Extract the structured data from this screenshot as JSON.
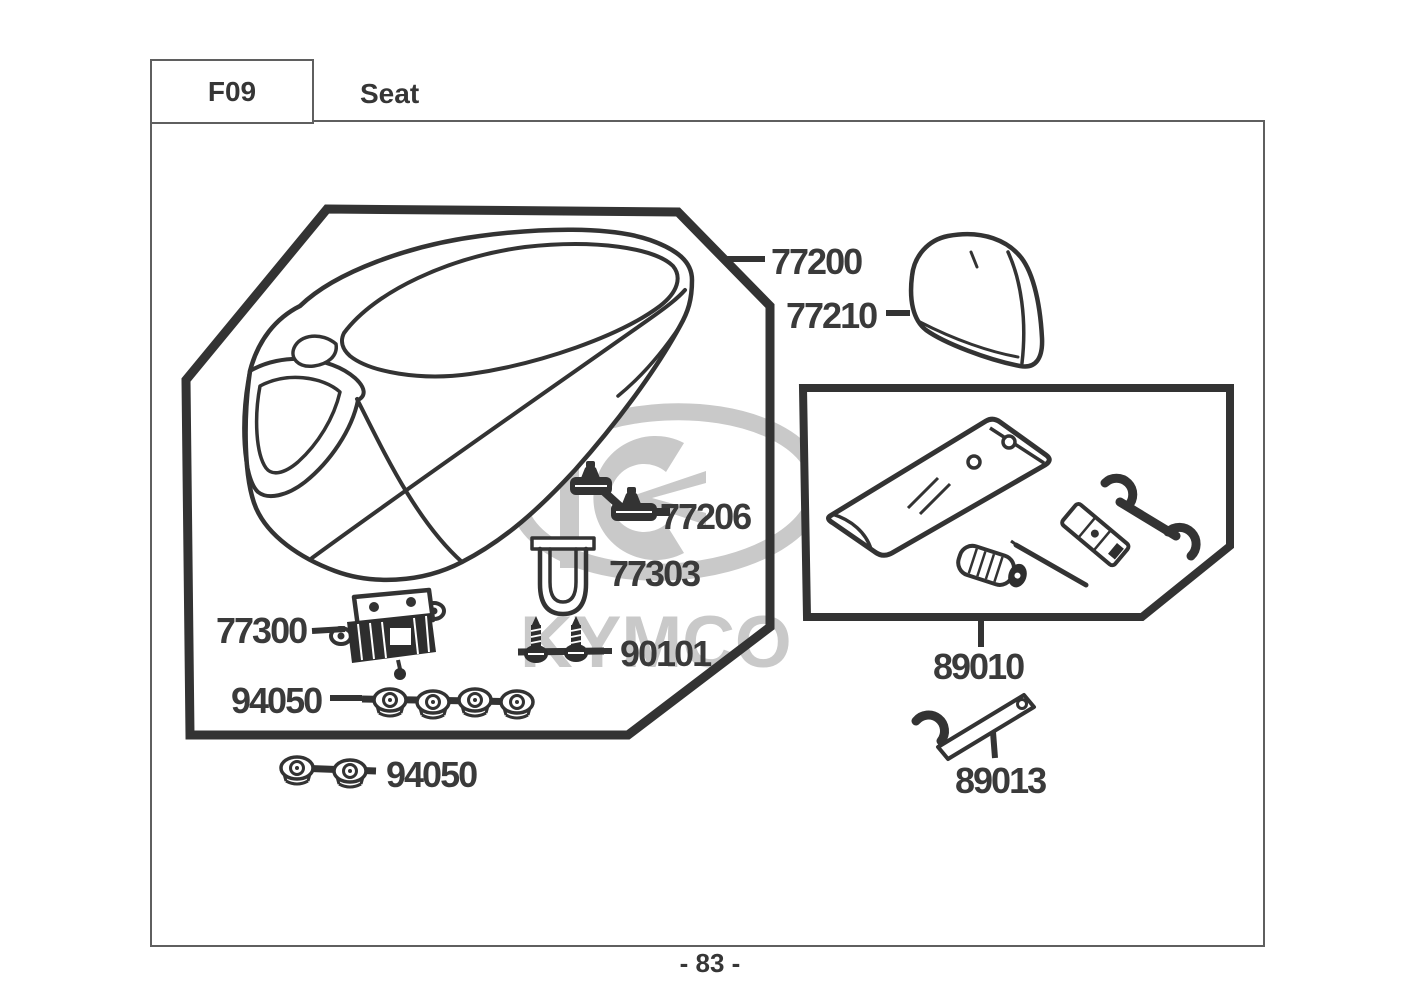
{
  "header": {
    "section_code": "F09",
    "section_title": "Seat"
  },
  "footer": {
    "page_number": "- 83 -"
  },
  "watermark": {
    "brand": "KYMCO",
    "color": "#c9c9c9"
  },
  "diagram": {
    "line_color": "#333333",
    "label_color": "#3a3a3a",
    "labels": {
      "p77200": "77200",
      "p77210": "77210",
      "p77206": "77206",
      "p77303": "77303",
      "p77300": "77300",
      "p90101": "90101",
      "p94050_row": "94050",
      "p94050_pair": "94050",
      "p89010": "89010",
      "p89013": "89013"
    },
    "icons": {
      "seat": "seat-assembly-illustration",
      "backrest": "backrest-pad-illustration",
      "toolkit": "tool-kit-illustration",
      "spanner": "hook-spanner-illustration"
    }
  }
}
